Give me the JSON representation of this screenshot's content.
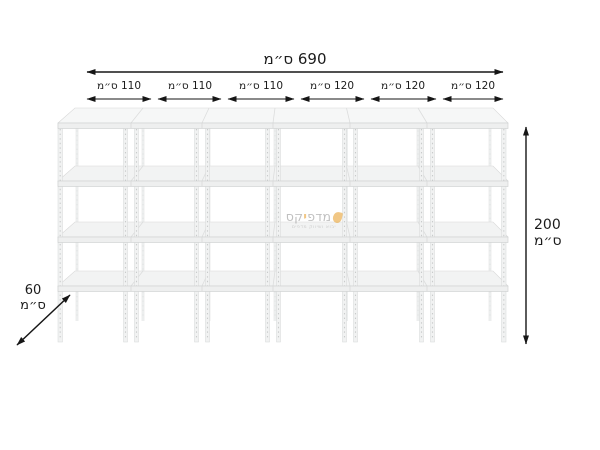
{
  "diagram": {
    "product": "metal-shelving-unit",
    "bays": 6,
    "shelf_levels": 4,
    "total_width_label": "690 ס״מ",
    "segments": [
      {
        "label": "110 ס״מ"
      },
      {
        "label": "110 ס״מ"
      },
      {
        "label": "110 ס״מ"
      },
      {
        "label": "120 ס״מ"
      },
      {
        "label": "120 ס״מ"
      },
      {
        "label": "120 ס״מ"
      }
    ],
    "height": {
      "value": "200",
      "unit": "ס״מ"
    },
    "depth": {
      "value": "60",
      "unit": "ס״מ"
    }
  },
  "watermark": {
    "brand": "מדפיקס",
    "brand_prefix": "מדפ",
    "brand_accent_letter": "י",
    "brand_suffix": "קס",
    "tagline": "יבוא ושיווק מדפים",
    "accent_color": "#e9a63b",
    "text_color": "#9a9a9a"
  },
  "colors": {
    "background": "#ffffff",
    "dimension_lines": "#161616",
    "shelf_fill": "#f2f3f3",
    "post_fill": "#f1f2f2",
    "accent": "#e9a63b"
  }
}
